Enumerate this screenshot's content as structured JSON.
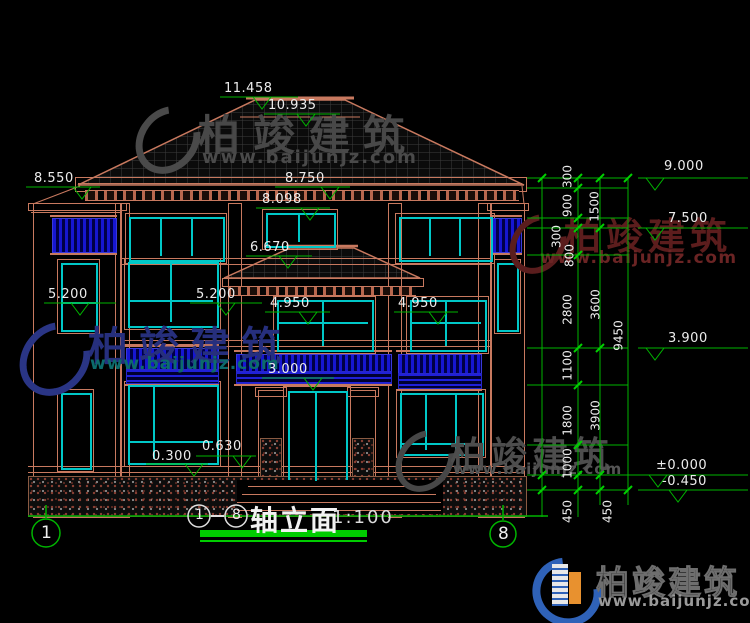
{
  "watermark": {
    "brand": "柏竣建筑",
    "url": "www.baijunjz.com"
  },
  "title": {
    "axis_from": "1",
    "axis_to": "8",
    "name": "轴立面",
    "scale": "1:100"
  },
  "axis_bubbles": {
    "left": "1",
    "right": "8"
  },
  "levels": {
    "ridge": "11.458",
    "roof_edge": "10.935",
    "left_parapet": "8.550",
    "eave": "8.750",
    "attic_window": "8.098",
    "porch_eave": "6.670",
    "lintel_left": "5.200",
    "lintel_mid": "5.200",
    "sill_bay_left": "4.950",
    "sill_bay_right": "4.950",
    "door_top": "3.000",
    "sill_upper": "0.630",
    "sill_lower": "0.300"
  },
  "right_levels": {
    "l9000": "9.000",
    "l7500": "7.500",
    "l3900": "3.900",
    "l0000": "±0.000",
    "lm0450": "-0.450"
  },
  "dims": {
    "col1": [
      "300",
      "900",
      "300",
      "800",
      "2800",
      "1100",
      "1800",
      "1000",
      "450"
    ],
    "col2": [
      "1500",
      "3600",
      "3900",
      "450"
    ],
    "overall": "9450"
  },
  "colors": {
    "line": "#c8795f",
    "glass": "#00c8c8",
    "dimension": "#00b400",
    "railing": "#1616d2"
  }
}
